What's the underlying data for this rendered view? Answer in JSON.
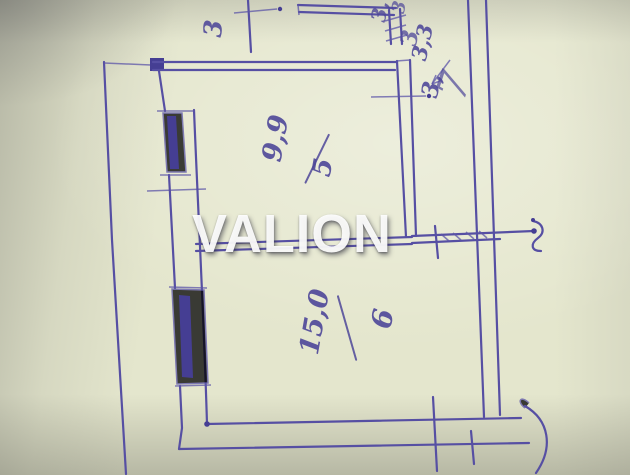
{
  "watermark": {
    "text": "VALION"
  },
  "plan": {
    "room_5": {
      "area": "9,9",
      "number": "5"
    },
    "room_6": {
      "area": "15,0",
      "number": "6"
    },
    "annotations": [
      {
        "id": "area-3-3",
        "text": "3,3"
      },
      {
        "id": "number-3-arrow",
        "text": "3,"
      },
      {
        "id": "room-7",
        "text": "7"
      },
      {
        "id": "scribble-top-left",
        "text": "3"
      },
      {
        "id": "scribble-top-a",
        "text": "3,"
      },
      {
        "id": "scribble-top-b",
        "text": "3"
      },
      {
        "id": "scribble-top-c",
        "text": "3"
      }
    ]
  },
  "colors": {
    "ink": "#564fa3",
    "paper": "#e4e6cd",
    "watermark": "#ffffff"
  }
}
